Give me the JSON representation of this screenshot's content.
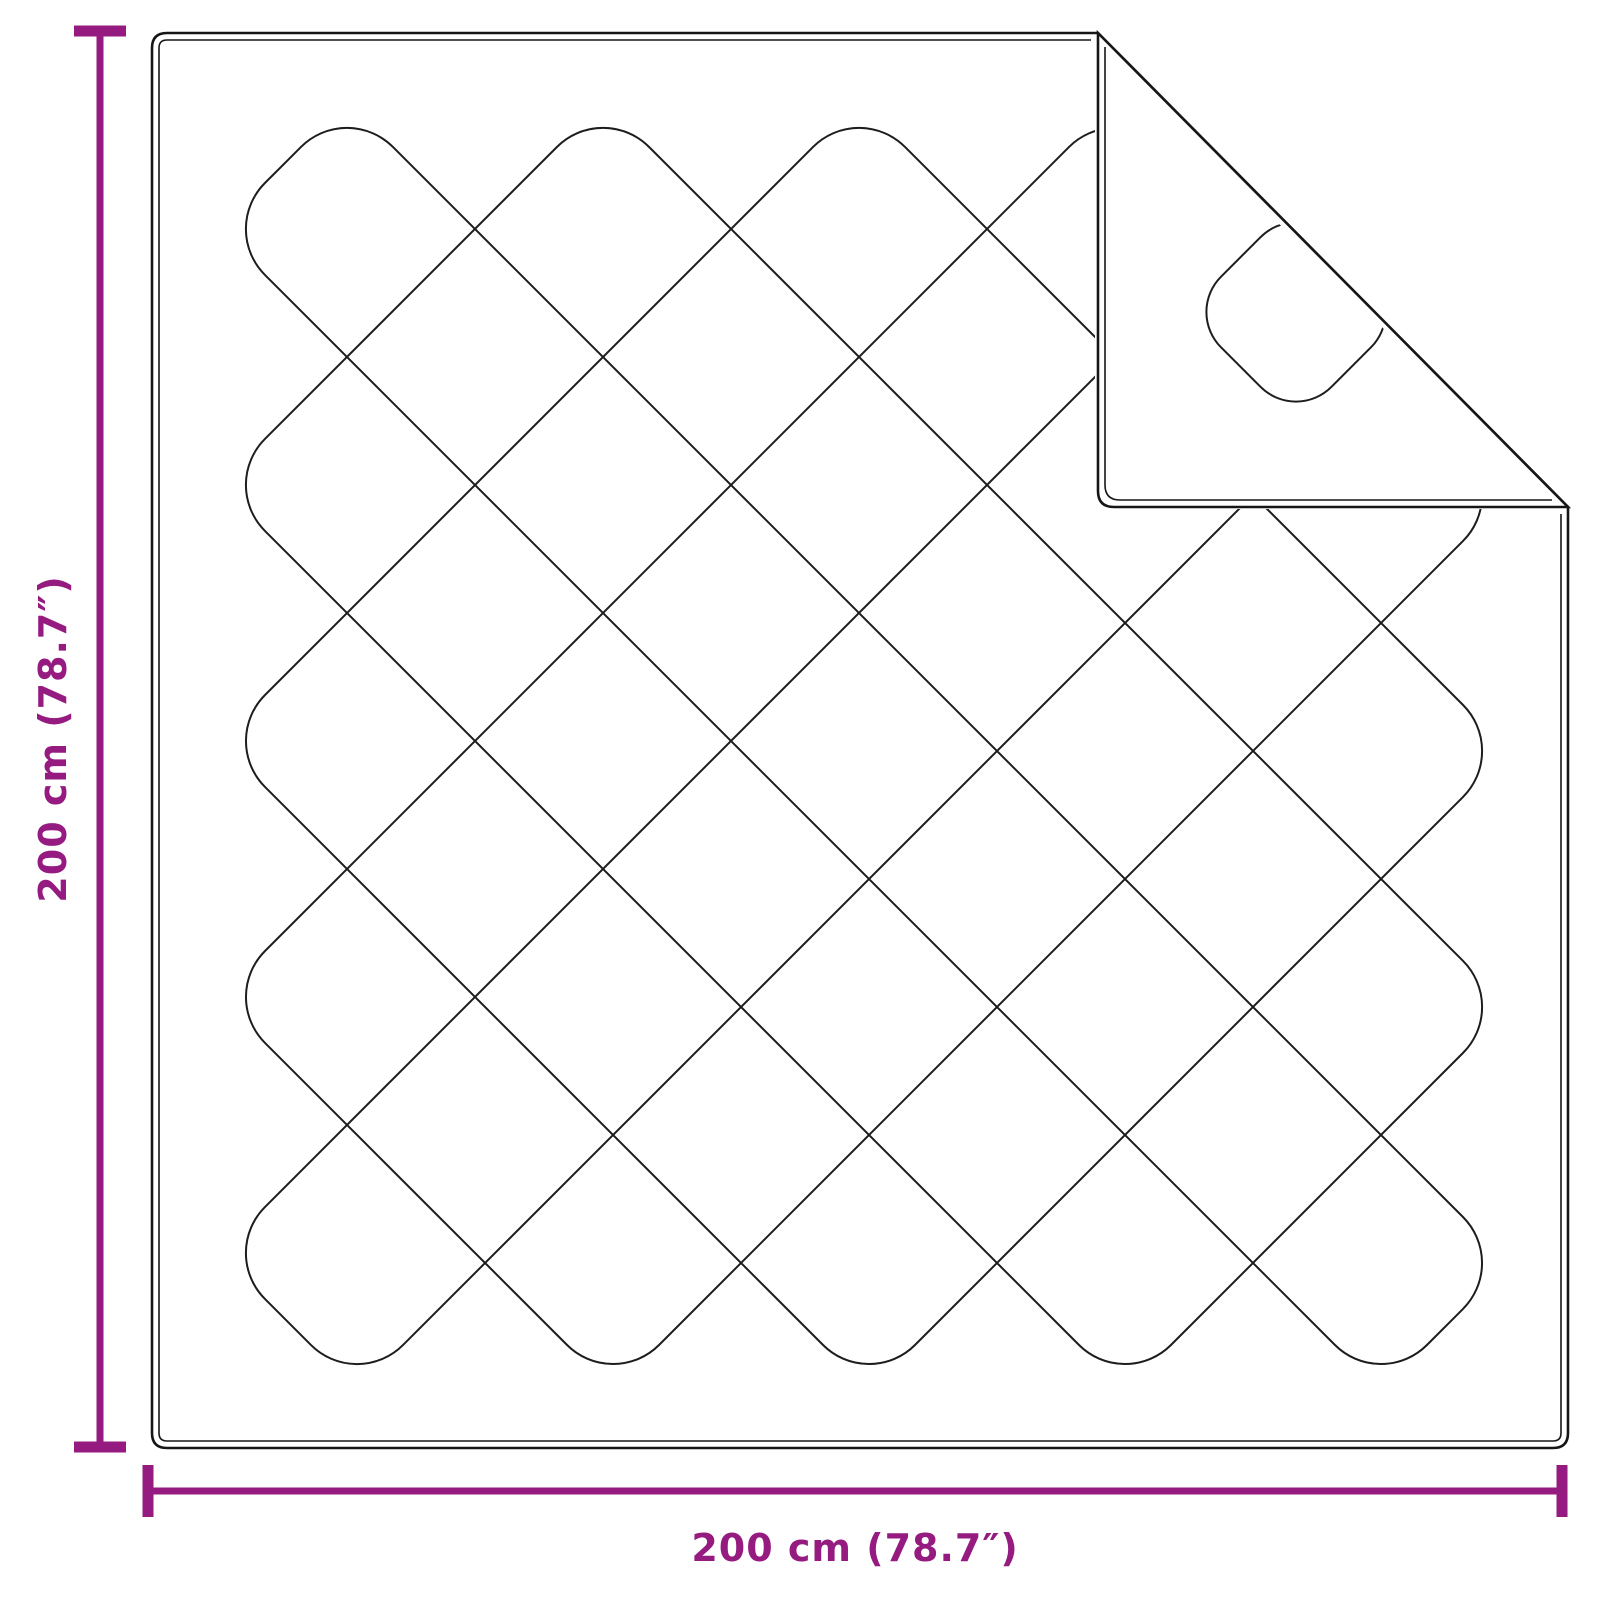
{
  "diagram": {
    "subject": "quilted-blanket-with-folded-corner",
    "height_dimension_label": "200 cm (78.7″)",
    "width_dimension_label": "200 cm (78.7″)",
    "colors": {
      "accent": "#951B81",
      "stitch": "#1D1D1D",
      "outline": "#161616",
      "background": "#FFFFFF"
    }
  }
}
